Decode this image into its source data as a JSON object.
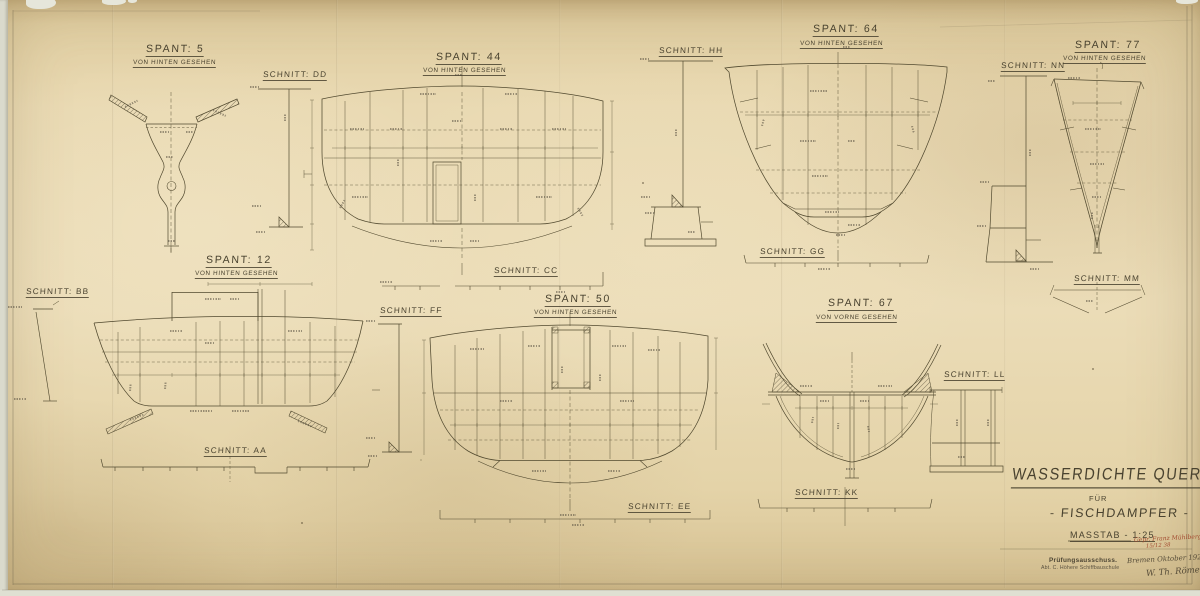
{
  "views": {
    "spant5": {
      "title": "SPANT: 5",
      "subtitle": "VON HINTEN GESEHEN"
    },
    "spant12": {
      "title": "SPANT: 12",
      "subtitle": "VON HINTEN GESEHEN"
    },
    "spant44": {
      "title": "SPANT: 44",
      "subtitle": "VON HINTEN GESEHEN"
    },
    "spant50": {
      "title": "SPANT: 50",
      "subtitle": "VON HINTEN GESEHEN"
    },
    "spant64": {
      "title": "SPANT: 64",
      "subtitle": "VON HINTEN GESEHEN"
    },
    "spant67": {
      "title": "SPANT: 67",
      "subtitle": "VON VORNE GESEHEN"
    },
    "spant77": {
      "title": "SPANT: 77",
      "subtitle": "VON HINTEN GESEHEN"
    }
  },
  "sections": {
    "aa": "SCHNITT: AA",
    "bb": "SCHNITT: BB",
    "cc": "SCHNITT: CC",
    "dd": "SCHNITT: DD",
    "ee": "SCHNITT: EE",
    "ff": "SCHNITT: FF",
    "gg": "SCHNITT: GG",
    "hh": "SCHNITT: HH",
    "kk": "SCHNITT: KK",
    "ll": "SCHNITT: LL",
    "mm": "SCHNITT: MM",
    "nn": "SCHNITT: NN"
  },
  "title_block": {
    "title": "WASSERDICHTE QUERSCHOTTE",
    "fuer": "FÜR",
    "subject": "- FISCHDAMPFER -",
    "scale": "MASSTAB - 1:25",
    "approval": "Gepr. Franz Mühlberg",
    "approval_date": "15/12 38",
    "stamp_line1": "Prüfungsausschuss.",
    "stamp_line2": "Abt. C. Höhere Schiffbauschule",
    "place_date": "Bremen Oktober 1929",
    "signature": "W. Th. Römer"
  },
  "colors": {
    "paper": "#e9d9b2",
    "ink": "#4a4336",
    "red": "#a24a2f"
  }
}
